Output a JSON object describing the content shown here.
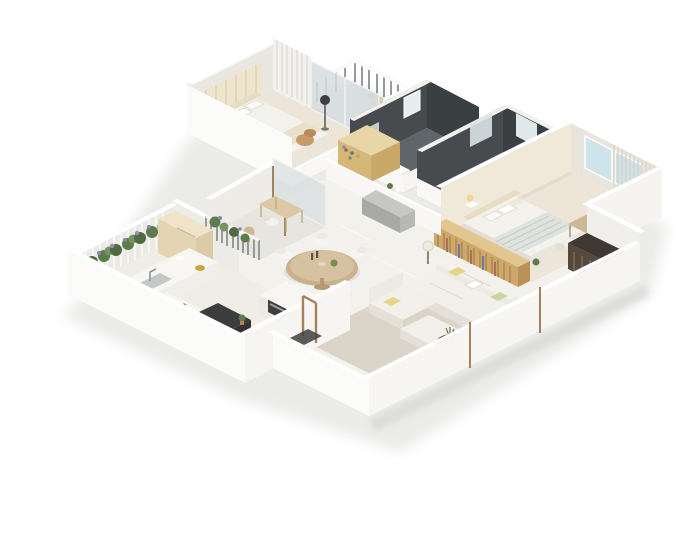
{
  "scene": {
    "kind": "isometric-3d-floor-plan-render",
    "background": "#ffffff",
    "view": "cutaway apartment seen from south-west, white walls, no text labels"
  },
  "palette": {
    "shadow": "#dcdbd8",
    "floor_main": "#f3f1ec",
    "floor_bedroom": "#ece5d8",
    "floor_kitchen": "#f0ede6",
    "floor_balcony": "#e7e5e0",
    "floor_bath": "#5f6669",
    "floor_bath2": "#596062",
    "rug": "#dbd5c9",
    "wall_outer": "#fbfbfa",
    "wall_outer_se": "#f6f5f2",
    "wall_inner": "#eae7e1",
    "wall_cream": "#f0e8d8",
    "wall_dark": "#474b4e",
    "wall_dark2": "#3a3f42",
    "window_glass": "#cfe4ea",
    "glass_door": "#d7dee0",
    "sofa": "#f2f0ea",
    "sofa_shadow": "#e4e0d7",
    "pillow_yellow": "#e6d488",
    "pillow_green": "#cbd69e",
    "bed_white": "#f4f2ec",
    "duvet": "#dfe3e0",
    "wood_desk": "#cdb795",
    "wood_table": "#c9b18c",
    "wood_shelf_front": "#cfa869",
    "wood_shelf_top": "#e2c68f",
    "dress_shelf": "#d3b877",
    "coffee_wood": "#8a5c38",
    "coffee_wood2": "#a06a40",
    "credenza": "#c6c7c4",
    "appliance": "#2b2b2b",
    "tv_unit": "#55493f",
    "plant": "#5d7c4e",
    "plant_light": "#76945f",
    "flower": "#8d80b5",
    "gold": "#c9a63f",
    "frame_brown": "#a5825e",
    "railing": "#6b7074",
    "steel": "#c3c8c8",
    "tan_cabinet": "#e3d4b4"
  },
  "rooms": [
    {
      "id": "bedroom-2",
      "objects": [
        "double-bed",
        "arched-headboard-wall",
        "pillows",
        "nightstand",
        "floor-lamp",
        "armchair",
        "slatted-wardrobe",
        "sliding-glass-door"
      ]
    },
    {
      "id": "bedroom-balcony",
      "objects": [
        "metal-railing",
        "wicker-chair",
        "potted-plant"
      ]
    },
    {
      "id": "bathroom-1",
      "objects": [
        "dark-slate-walls",
        "window",
        "mirror",
        "vanity",
        "toilet"
      ]
    },
    {
      "id": "bathroom-2",
      "objects": [
        "dark-slate-walls",
        "window",
        "toilet",
        "pedestal-sink"
      ]
    },
    {
      "id": "hallway",
      "objects": [
        "dressing-shelf-with-items",
        "low-wall",
        "gray-credenza",
        "decor-plant"
      ]
    },
    {
      "id": "master-bedroom",
      "objects": [
        "double-bed",
        "striped-duvet",
        "pillows",
        "bedside-lamp",
        "blue-glass-windows",
        "slat-screen",
        "desk",
        "chair",
        "low-bookshelf-divider",
        "plant"
      ]
    },
    {
      "id": "dining-area",
      "objects": [
        "round-wood-table",
        "white-chairs",
        "fruit-bowl",
        "bottles"
      ]
    },
    {
      "id": "living-room",
      "objects": [
        "l-shaped-sofa",
        "chaise",
        "ottoman",
        "yellow-pillow",
        "green-pillow",
        "floor-lamp",
        "round-coffee-table",
        "side-coffee-table",
        "area-rug",
        "tv-console",
        "glass-door-frames"
      ]
    },
    {
      "id": "kitchen",
      "objects": [
        "sink-counter",
        "faucet",
        "golden-bowl",
        "cooktop",
        "black-oven-stack",
        "red-tray",
        "cactus",
        "island-with-steel-appliance",
        "tall-beige-cabinet",
        "entry-door-frame",
        "doormat"
      ]
    },
    {
      "id": "kitchen-garden-balcony",
      "objects": [
        "trellis",
        "climbing-plants",
        "purple-flowers"
      ]
    },
    {
      "id": "small-balcony",
      "objects": [
        "metal-railing",
        "planter-plants",
        "side-table",
        "chair",
        "vanity-desk",
        "glass-panel"
      ]
    }
  ]
}
